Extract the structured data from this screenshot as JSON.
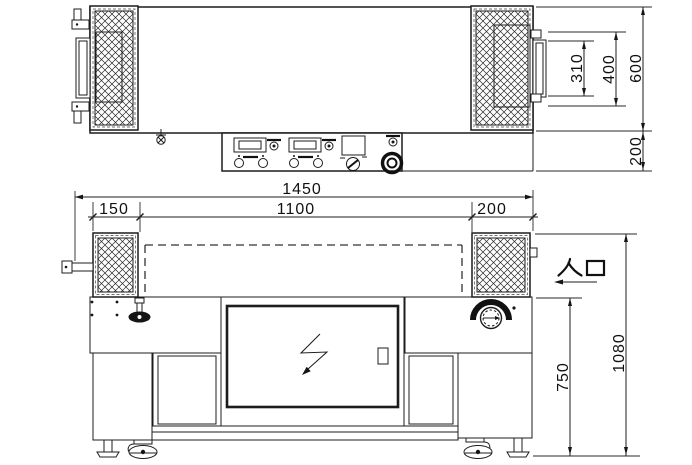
{
  "labels": {
    "entrance": "入口"
  },
  "dimensions": {
    "top": {
      "overall_width": "1450",
      "conveyor_width": "1100",
      "left_section": "150",
      "right_section": "200",
      "guard_door_depth": "310",
      "guard_opening_depth": "400",
      "body_depth": "600",
      "control_ledge_depth": "200"
    },
    "front": {
      "table_height": "750",
      "overall_height": "1080"
    }
  },
  "colors": {
    "line": "#1c1c1c",
    "background": "#ffffff"
  }
}
